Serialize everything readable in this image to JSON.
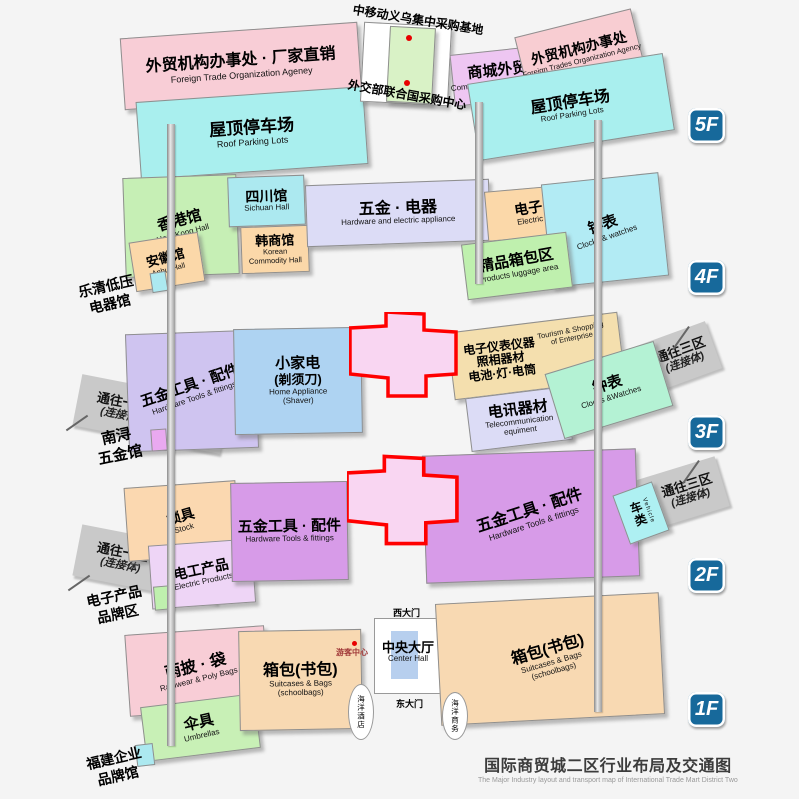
{
  "title": {
    "zh": "国际商贸城二区行业布局及交通图",
    "en": "The Major Industry layout and transport map of International Trade Mart District Two"
  },
  "badges": {
    "f5": "5F",
    "f4": "4F",
    "f3": "3F",
    "f2": "2F",
    "f1": "1F"
  },
  "f5": {
    "office_left_zh": "外贸机构办事处 · 厂家直销",
    "office_left_en": "Foreign Trade Organization Ageney",
    "parking_left_zh": "屋顶停车场",
    "parking_left_en": "Roof Parking Lots",
    "base_label": "中移动义乌集中采购基地",
    "un_center_label": "外交部联合国采购中心",
    "commodity_zh": "商城外贸",
    "commodity_en": "Commodity Foreign Trades",
    "office_right_zh": "外贸机构办事处",
    "office_right_en": "Foreign Trades Organization Agency",
    "parking_right_zh": "屋顶停车场",
    "parking_right_en": "Roof Parking Lots"
  },
  "f4": {
    "hongkong_zh": "香港馆",
    "hongkong_en": "HongKong Hall",
    "sichuan_zh": "四川馆",
    "sichuan_en": "Sichuan Hall",
    "korean_zh": "韩商馆",
    "korean_en1": "Korean",
    "korean_en2": "Commodity Hall",
    "anhui_zh": "安徽馆",
    "anhui_en": "Anhui Hall",
    "hardware_zh": "五金 · 电器",
    "hardware_en": "Hardware and electric appliance",
    "electric_zh": "电子",
    "electric_en": "Electric",
    "clocks_zh": "钟表",
    "clocks_en": "Clocks & watches",
    "luggage_zh": "精品箱包区",
    "luggage_en": "Products luggage area",
    "ann_yueqing_1": "乐清低压",
    "ann_yueqing_2": "电器馆"
  },
  "f3": {
    "tools_zh": "五金工具 · 配件",
    "tools_en": "Hardware Tools & fittings",
    "appliance_zh1": "小家电",
    "appliance_zh2": "(剃须刀)",
    "appliance_en1": "Home Appliance",
    "appliance_en2": "(Shaver)",
    "instrument_zh1": "电子仪表仪器",
    "instrument_zh2": "照相器材",
    "instrument_zh3": "电池·灯·电筒",
    "instrument_en1": "Tourism & Shopping",
    "instrument_en2": "of Enterprise",
    "telecom_zh": "电讯器材",
    "telecom_en1": "Telecommunication",
    "telecom_en2": "equiment",
    "clocks_zh": "钟表",
    "clocks_en": "Clocks &Watches",
    "arm1_zh": "通往一区",
    "arm1_sub": "(连接体)",
    "arm3_zh": "通往三区",
    "arm3_sub": "(连接体)",
    "ann_nanxun_1": "南浔",
    "ann_nanxun_2": "五金馆"
  },
  "f2": {
    "lock_zh": "锁具",
    "lock_en": "Stock",
    "electric_zh": "电工产品",
    "electric_en": "Electric Products",
    "tools_mid_zh": "五金工具 · 配件",
    "tools_mid_en": "Hardware Tools & fittings",
    "tools_right_zh": "五金工具 · 配件",
    "tools_right_en": "Hardware Tools & fittings",
    "vehicle_zh": "车类",
    "vehicle_en": "Vehicle",
    "arm1_zh": "通往一区",
    "arm1_sub": "(连接体)",
    "arm3_zh": "通往三区",
    "arm3_sub": "(连接体)",
    "ann_brand_1": "电子产品",
    "ann_brand_2": "品牌区"
  },
  "f1": {
    "rain_zh": "雨披 · 袋",
    "rain_en": "Rainwear & Poly Bags",
    "umbrella_zh": "伞具",
    "umbrella_en": "Umbrellas",
    "bags_left_zh": "箱包(书包)",
    "bags_left_en1": "Suitcases & Bags",
    "bags_left_en2": "(schoolbags)",
    "bags_right_zh": "箱包(书包)",
    "bags_right_en1": "Suitcases & Bags",
    "bags_right_en2": "(schoolbags)",
    "hall_zh": "中央大厅",
    "hall_en": "Center Hall",
    "west_gate": "西大门",
    "east_gate": "东大门",
    "tourist_center": "游客中心",
    "hotel": "海洋酒店",
    "business": "海洋商务",
    "ann_fujian_1": "福建企业",
    "ann_fujian_2": "品牌馆"
  },
  "palette": {
    "badge_bg": "#17699b",
    "cross_fill": "#f9d6f2",
    "cross_border": "#ff0000",
    "dot_red": "#e80000",
    "arm_gray": "#c9c9c9",
    "pink": "#f8cdd6",
    "cyan_parking": "#a9efee",
    "green_base": "#d9f2c6",
    "purple_trade": "#eec6f2",
    "lavender": "#dcdcf6",
    "orange": "#fbd8a9",
    "purple_tools_2f": "#d79be8",
    "blue_appliance": "#aed3f2",
    "tan_instrument": "#f4dfae",
    "mint_clocks": "#b4f2d4"
  }
}
